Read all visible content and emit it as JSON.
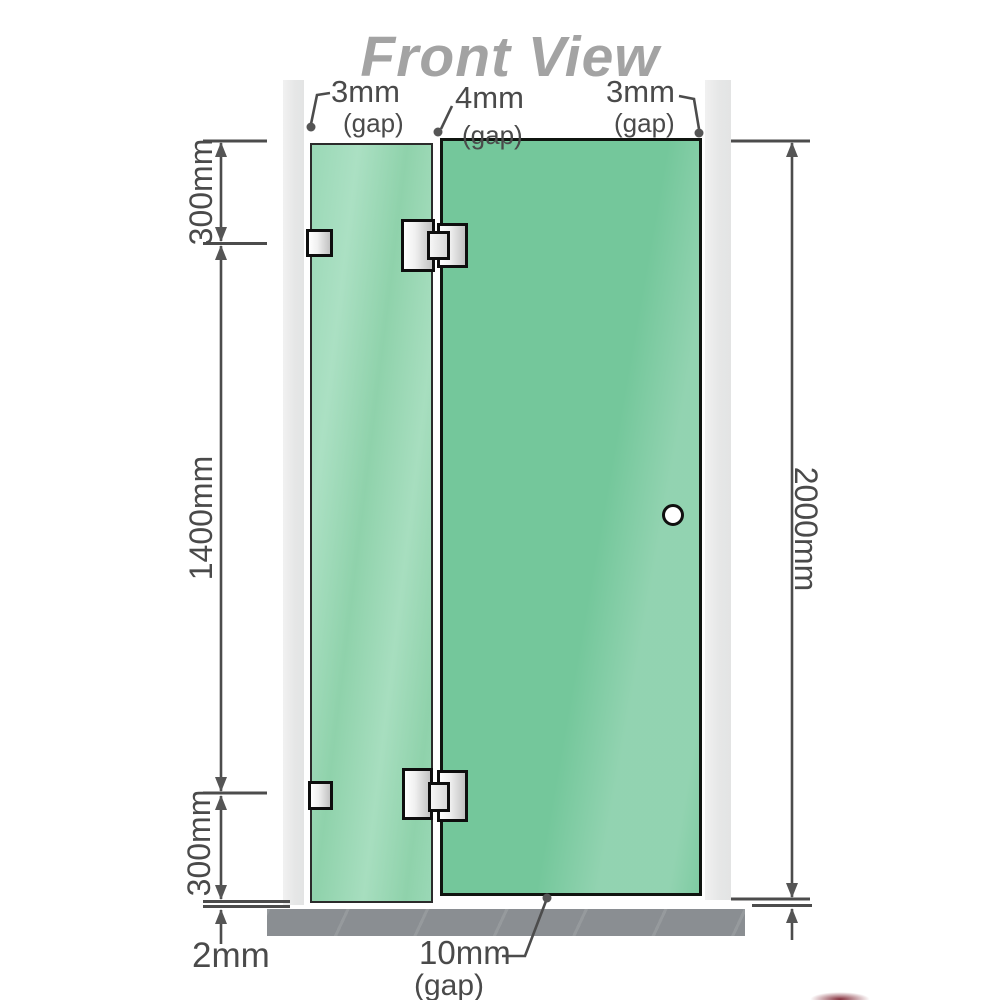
{
  "title": "Front View",
  "annotations": {
    "gap_top_left": {
      "value": "3mm",
      "label": "(gap)"
    },
    "gap_top_middle": {
      "value": "4mm",
      "label": "(gap)"
    },
    "gap_top_right": {
      "value": "3mm",
      "label": "(gap)"
    },
    "segment_top": "300mm",
    "segment_middle": "1400mm",
    "segment_bottom": "300mm",
    "overall_height": "2000mm",
    "floor_gap_left": "2mm",
    "gap_bottom_middle": {
      "value": "10mm",
      "label": "(gap)"
    }
  },
  "colors": {
    "glass_fixed_panel": "#9ad8b6",
    "glass_door_panel": "#74c79b",
    "glass_highlight": "#b9e6cc",
    "wall": "#e9eaea",
    "floor_base": "#8a8e92",
    "dimension_line": "#4c4c4c",
    "label_text": "#4a4a4a",
    "title_text": "#a3a3a3",
    "hardware_fill": "#e8e8e8",
    "hardware_border": "#0e0e0e"
  }
}
